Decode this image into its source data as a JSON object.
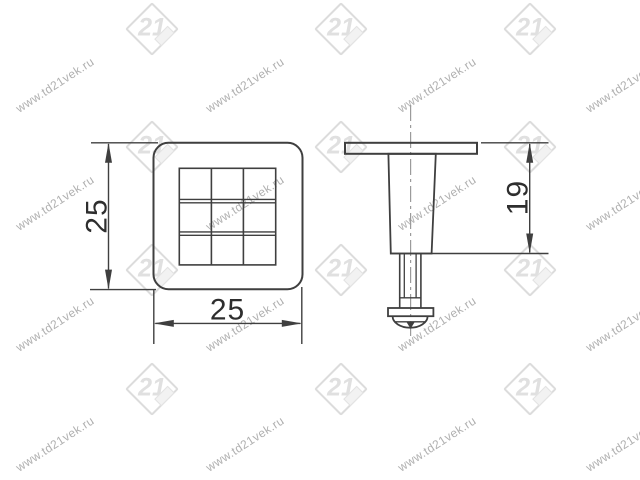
{
  "page": {
    "background": "#ffffff"
  },
  "watermark": {
    "text": "www.td21vek.ru",
    "logo_text": "21",
    "text_color": "#b0b0b0",
    "logo_color": "#dcdcdc",
    "text_columns_x": [
      55,
      245,
      437,
      625
    ],
    "text_rows_y": [
      85,
      203,
      324,
      444
    ],
    "logo_columns_x": [
      152,
      341,
      530
    ],
    "logo_rows_y": [
      29,
      147,
      270,
      389
    ]
  },
  "drawing": {
    "line_color": "#3f3f3f",
    "dimension_text_color": "#2e2e2e",
    "centerline_color": "#9b9b9b",
    "front_view": {
      "width_label": "25",
      "height_label": "25",
      "grid": {
        "rows": 3,
        "cols": 3
      }
    },
    "side_view": {
      "height_label": "19"
    }
  }
}
